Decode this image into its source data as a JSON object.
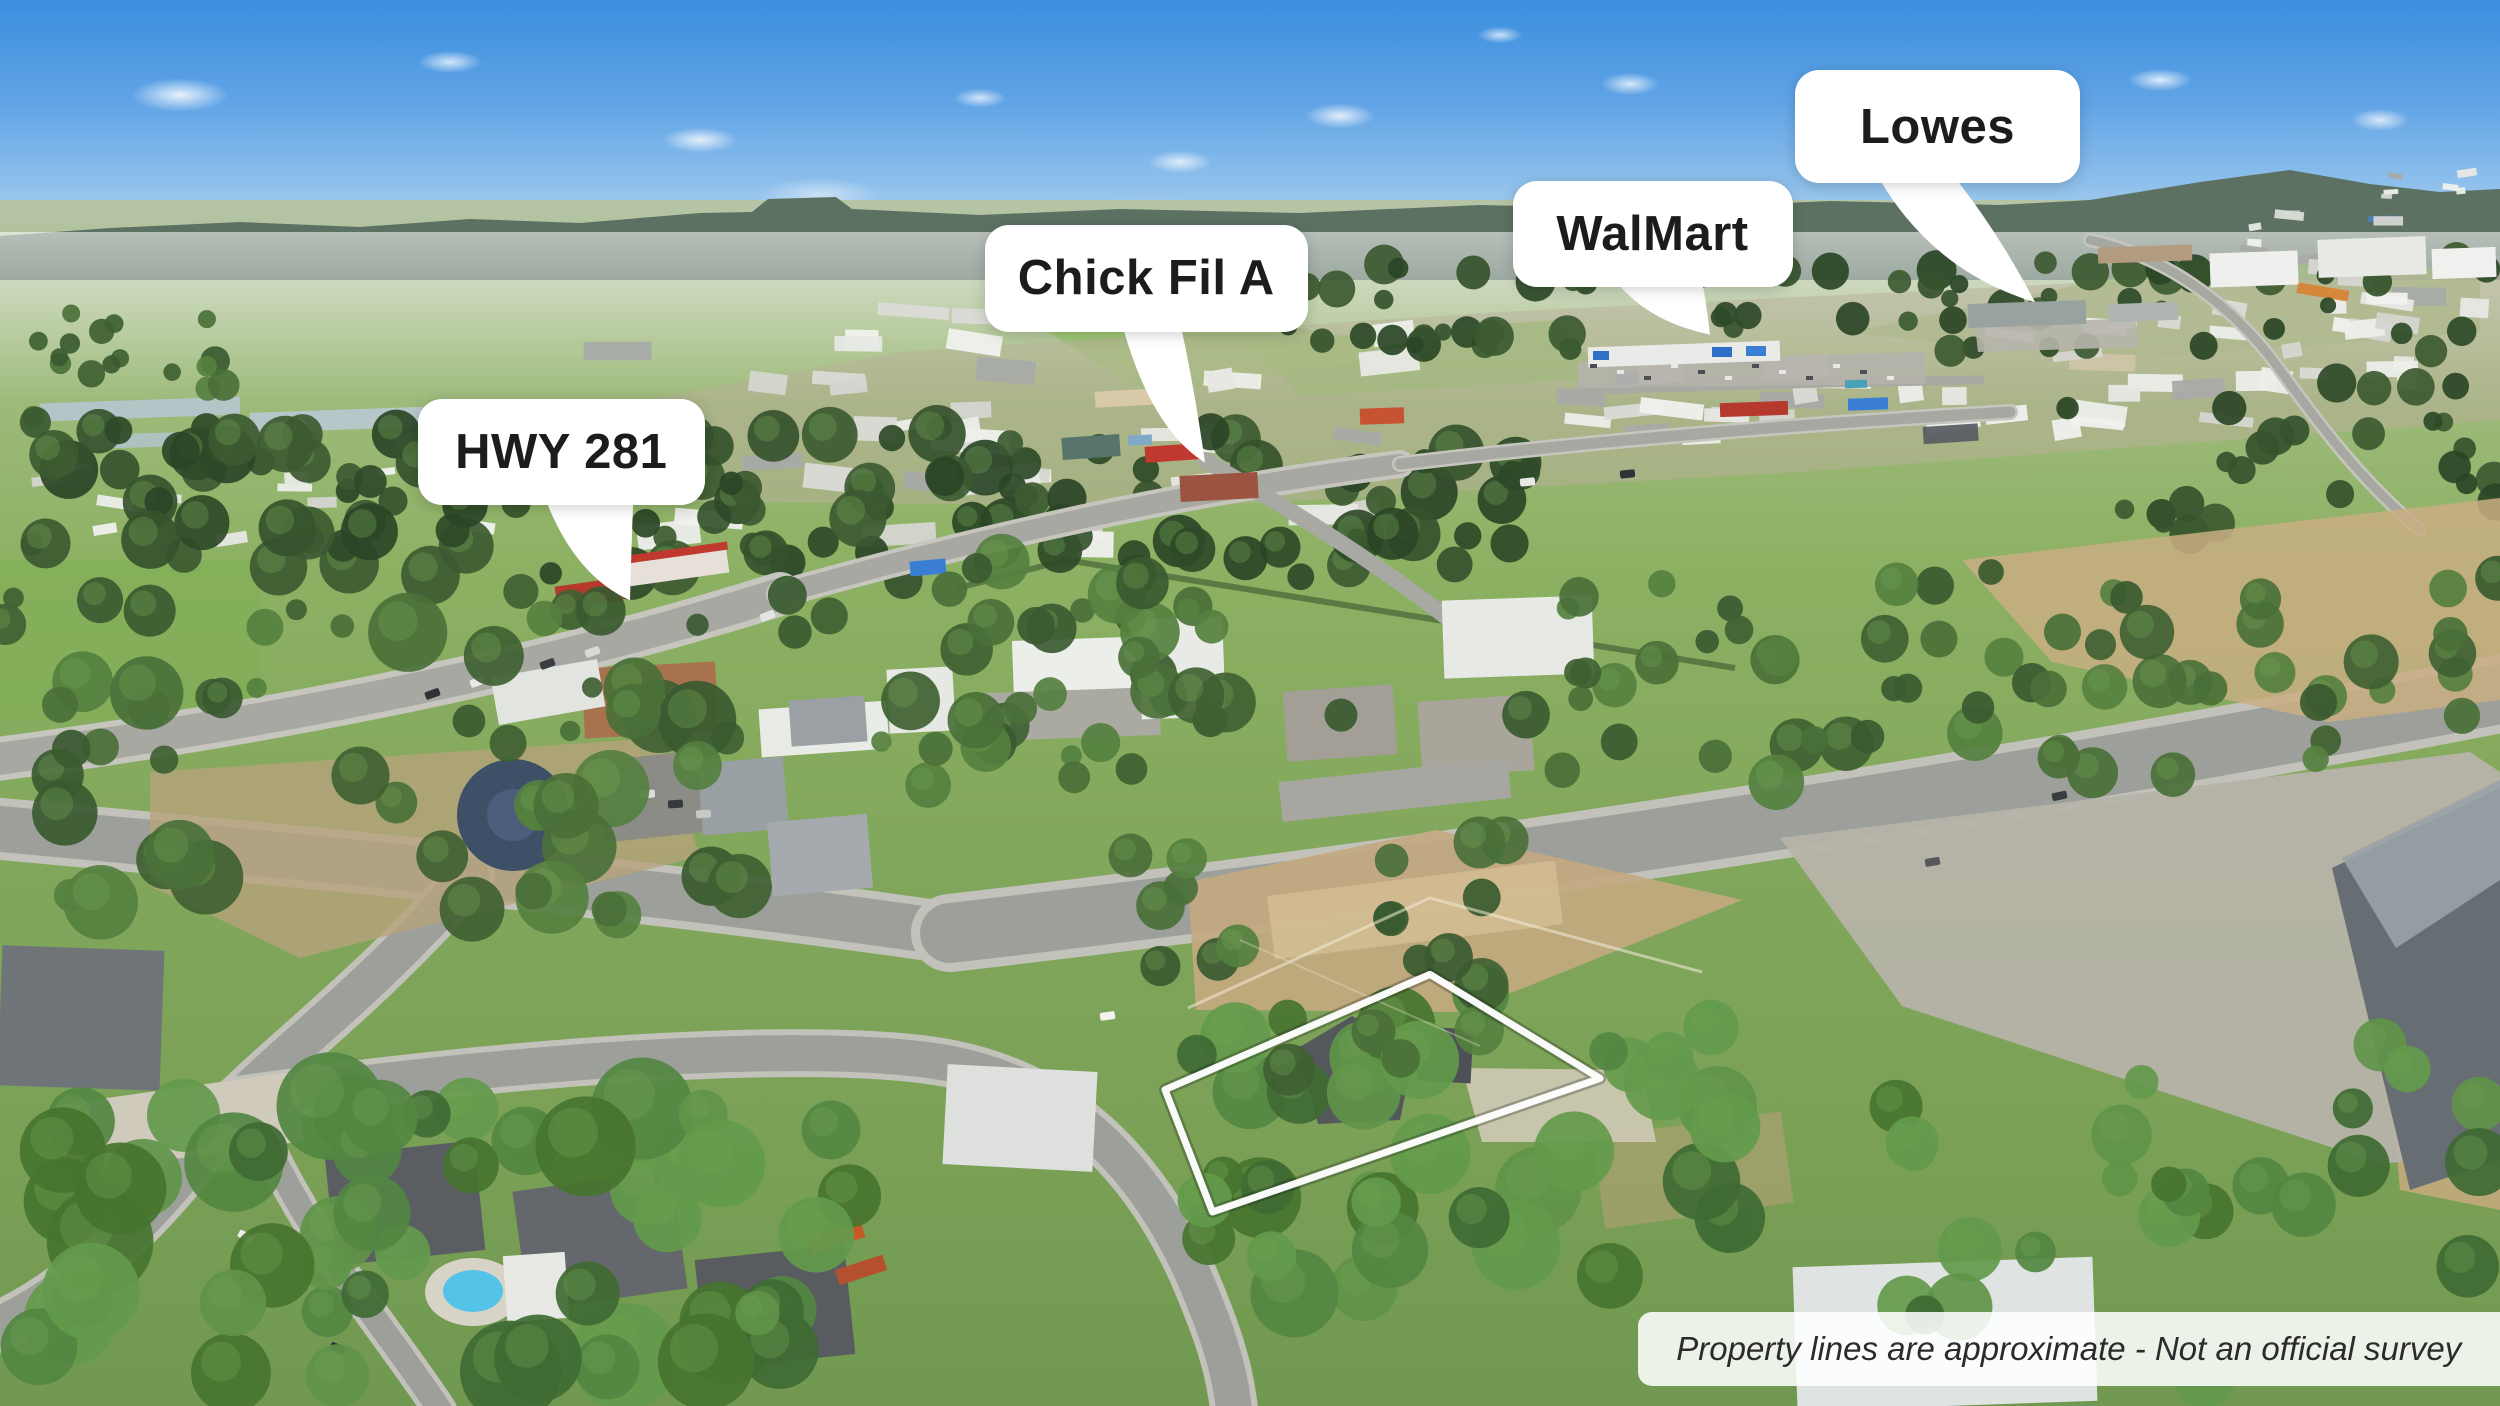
{
  "callouts": [
    {
      "name": "hwy-281",
      "label": "HWY 281",
      "box_pct": {
        "left": 16.7,
        "top": 28.4,
        "width": 11.5,
        "height": 7.5
      },
      "tail_tip_pct": {
        "x": 25.2,
        "y": 42.7
      }
    },
    {
      "name": "chick-fil-a",
      "label": "Chick Fil A",
      "box_pct": {
        "left": 39.4,
        "top": 16.0,
        "width": 12.9,
        "height": 7.6
      },
      "tail_tip_pct": {
        "x": 48.2,
        "y": 32.9
      }
    },
    {
      "name": "walmart",
      "label": "WalMart",
      "box_pct": {
        "left": 60.5,
        "top": 12.9,
        "width": 11.2,
        "height": 7.5
      },
      "tail_tip_pct": {
        "x": 68.4,
        "y": 23.8
      }
    },
    {
      "name": "lowes",
      "label": "Lowes",
      "box_pct": {
        "left": 71.8,
        "top": 5.0,
        "width": 11.4,
        "height": 8.0
      },
      "tail_tip_pct": {
        "x": 81.4,
        "y": 21.5
      }
    }
  ],
  "disclaimer": {
    "text": "Property lines are approximate - Not an official survey",
    "bar_pct": {
      "left": 65.5,
      "top": 93.3,
      "width": 34.5,
      "height": 5.3
    }
  },
  "property_boundary": {
    "stroke_color": "#ffffff",
    "points_pct": [
      [
        46.6,
        77.5
      ],
      [
        57.2,
        69.3
      ],
      [
        64.0,
        76.7
      ],
      [
        48.5,
        86.2
      ]
    ]
  },
  "palette": {
    "sky_top": "#3b8ede",
    "sky_horizon": "#c9dff2",
    "ridge": "#5d7163",
    "grass": "#7ca25a",
    "field_light": "#9cbf75",
    "tree_dark": "#35522c",
    "dirt_tan": "#c0a67c",
    "road_gray": "#9da09a",
    "callout_bg": "#ffffff",
    "callout_text": "#1c1c1c",
    "disclaimer_text": "#2b2b2b"
  }
}
